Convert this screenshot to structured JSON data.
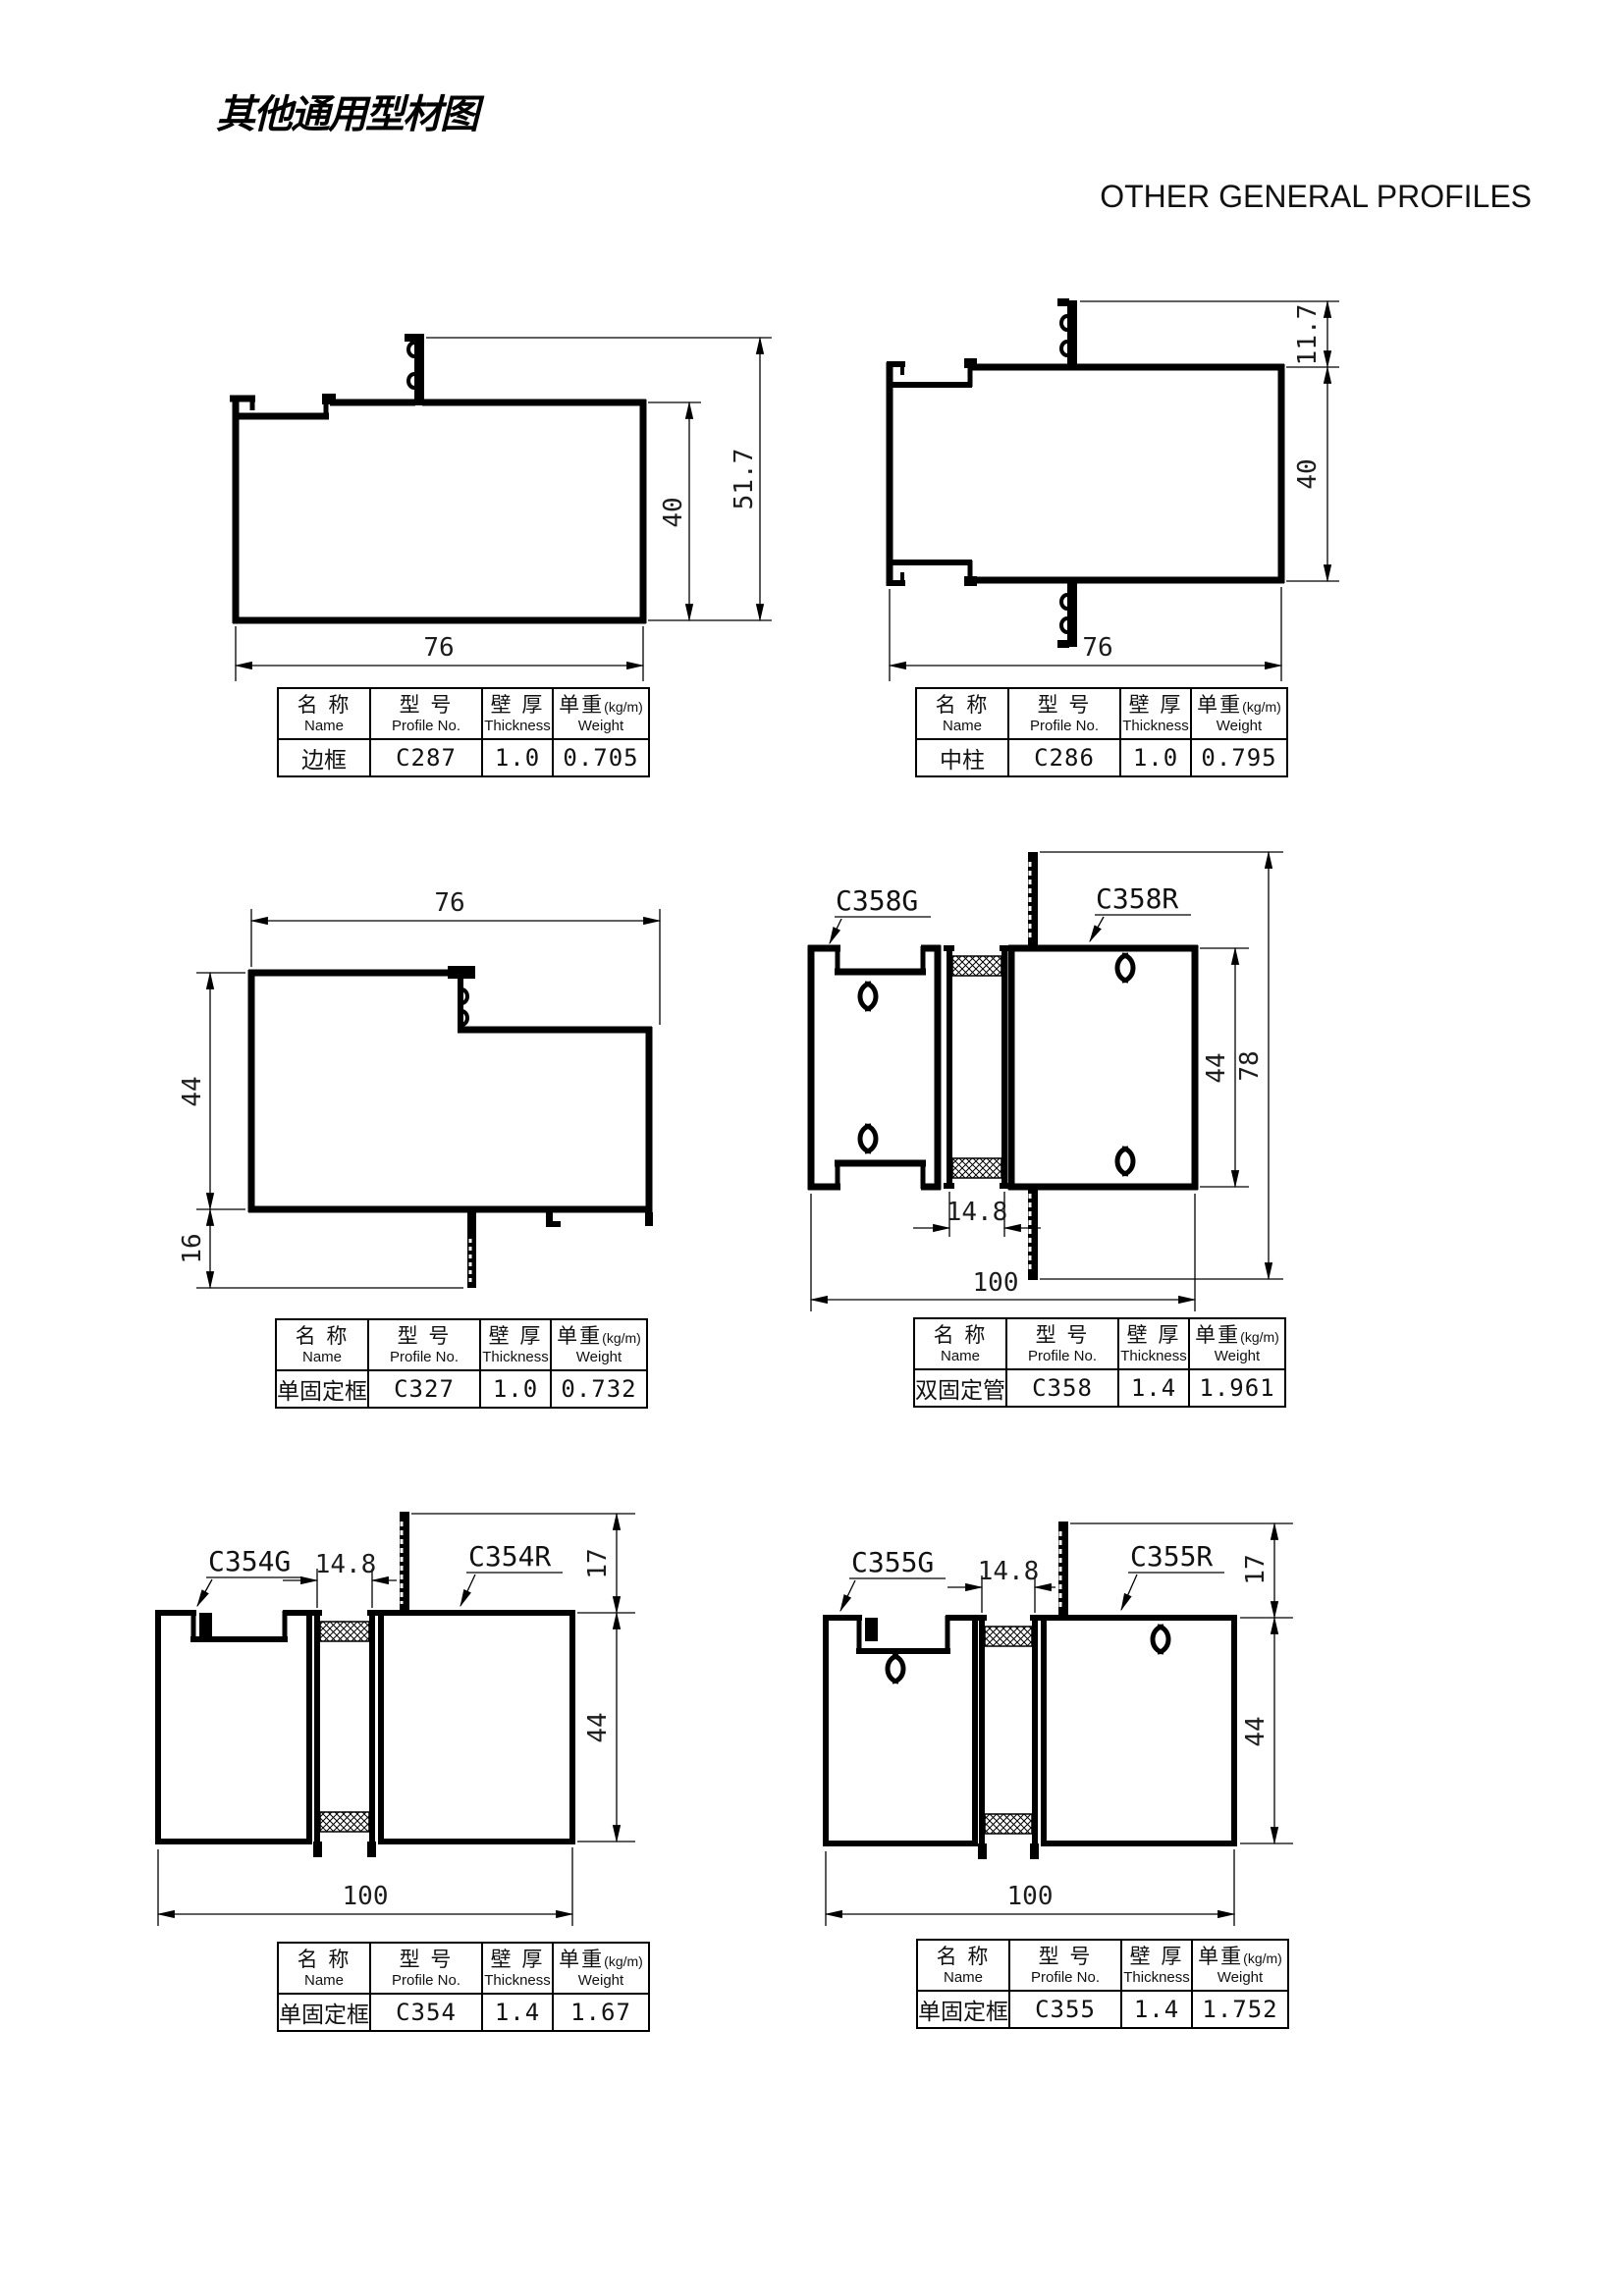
{
  "page": {
    "title": "其他通用型材图",
    "subtitle": "OTHER GENERAL PROFILES"
  },
  "table_headers": {
    "name_cn": "名 称",
    "name_en": "Name",
    "profile_cn": "型 号",
    "profile_en": "Profile No.",
    "thickness_cn": "壁 厚",
    "thickness_en": "Thickness",
    "weight_cn": "单重",
    "weight_unit": "(kg/m)",
    "weight_en": "Weight"
  },
  "drawings": [
    {
      "table": {
        "name": "边框",
        "profile_no": "C287",
        "thickness": "1.0",
        "weight": "0.705"
      },
      "dims": {
        "width": "76",
        "inner_height": "40",
        "overall_height": "51.7"
      }
    },
    {
      "table": {
        "name": "中柱",
        "profile_no": "C286",
        "thickness": "1.0",
        "weight": "0.795"
      },
      "dims": {
        "width": "76",
        "height": "40",
        "fin": "11.7"
      }
    },
    {
      "table": {
        "name": "单固定框",
        "profile_no": "C327",
        "thickness": "1.0",
        "weight": "0.732"
      },
      "dims": {
        "width": "76",
        "height": "44",
        "leg": "16"
      }
    },
    {
      "table": {
        "name": "双固定管",
        "profile_no": "C358",
        "thickness": "1.4",
        "weight": "1.961"
      },
      "labels": {
        "left": "C358G",
        "right": "C358R"
      },
      "dims": {
        "gap": "14.8",
        "width": "100",
        "height": "44",
        "overall": "78"
      }
    },
    {
      "table": {
        "name": "单固定框",
        "profile_no": "C354",
        "thickness": "1.4",
        "weight": "1.67"
      },
      "labels": {
        "left": "C354G",
        "right": "C354R"
      },
      "dims": {
        "gap": "14.8",
        "fin": "17",
        "height": "44",
        "width": "100"
      }
    },
    {
      "table": {
        "name": "单固定框",
        "profile_no": "C355",
        "thickness": "1.4",
        "weight": "1.752"
      },
      "labels": {
        "left": "C355G",
        "right": "C355R"
      },
      "dims": {
        "gap": "14.8",
        "fin": "17",
        "height": "44",
        "width": "100"
      }
    }
  ]
}
